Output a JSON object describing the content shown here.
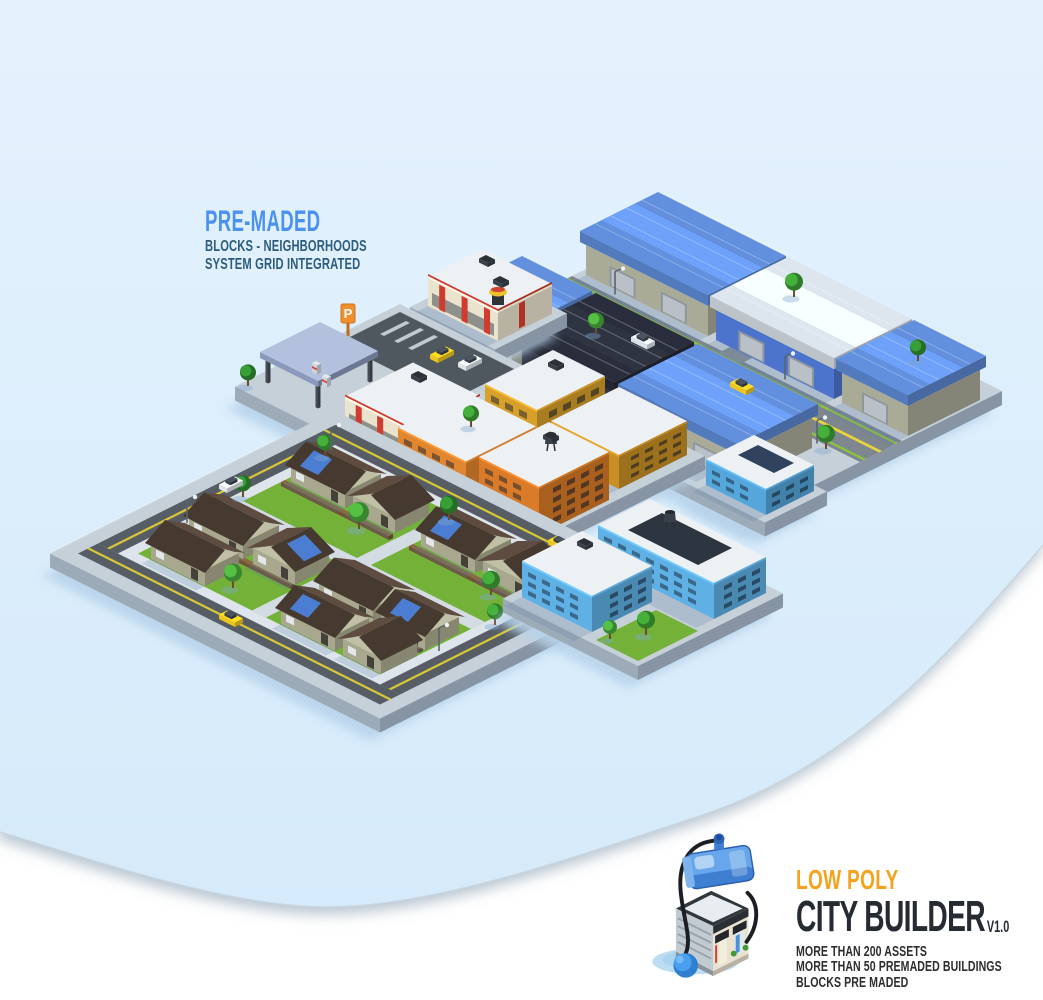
{
  "promo": {
    "headline": "PRE-MADED",
    "sub1": "BLOCKS - NEIGHBORHOODS",
    "sub2": "SYSTEM GRID INTEGRATED",
    "headline_color": "#4a91f0",
    "sub_color": "#2d5c7e"
  },
  "branding": {
    "tagline": "LOW POLY",
    "title": "CITY BUILDER",
    "version": "V1.0",
    "features": [
      "MORE THAN 200 ASSETS",
      "MORE THAN 50 PREMADED BUILDINGS",
      "BLOCKS PRE MADED"
    ],
    "tagline_color": "#f6a21c",
    "title_color": "#262b33",
    "features_color": "#2d2d30",
    "logo_icon": "isometric-shop-with-blue-tank-icon"
  },
  "background": {
    "page_color": "#ffffff",
    "panel_color_top": "#e4f2fd",
    "panel_color_bottom": "#d5eafa",
    "panel_edge_color": "#c6d3de"
  },
  "scene": {
    "anchors": {
      "ind": {
        "x": 672,
        "y": 240
      },
      "rest": {
        "x": 482,
        "y": 285
      },
      "com": {
        "x": 400,
        "y": 318
      },
      "mix": {
        "x": 555,
        "y": 395
      },
      "res": {
        "x": 335,
        "y": 425
      },
      "blu2": {
        "x": 752,
        "y": 468
      },
      "blu": {
        "x": 648,
        "y": 540
      }
    },
    "blocks": {
      "ind": "industrial-district",
      "rest": "restaurant-block",
      "com": "gas-station-block",
      "mix": "apartment-district",
      "res": "residential-suburb",
      "blu2": "corner-store-block",
      "blu": "blue-apartment-block"
    },
    "palette": {
      "platTop": "#c6d0d9",
      "platR": "#8694a3",
      "platL": "#9dabb9",
      "shadow": "rgba(86,124,166,0.22)",
      "asphalt": "#7e868e",
      "asphalt2": "#878f97",
      "edgegreen": "#8fc43e",
      "yellow": "#e8d63c",
      "yellow2": "#d8c636",
      "roadDark": "#565d64",
      "sidewalk": "#dde4ec",
      "path": "#d3dbe3",
      "lawn": "#74b138",
      "lot": "#4f575f",
      "mark": "#c2cad1",
      "panel": "#31425e",
      "court": "#2c3540",
      "whouse": "#a9ab97",
      "wroof": "#6290de"
    },
    "items": [
      {
        "t": "platform",
        "b": "ind",
        "u0": 0,
        "v0": 0,
        "u1": 330,
        "v1": 250,
        "h": 14
      },
      {
        "t": "strip",
        "b": "ind",
        "u0": 0,
        "v0": 100,
        "u1": 330,
        "v1": 142,
        "c": "asphalt"
      },
      {
        "t": "strip",
        "b": "ind",
        "u0": 150,
        "v0": 0,
        "u1": 172,
        "v1": 250,
        "c": "asphalt2"
      },
      {
        "t": "strip",
        "b": "ind",
        "u0": 0,
        "v0": 104,
        "u1": 330,
        "v1": 106.5,
        "c": "edgegreen"
      },
      {
        "t": "strip",
        "b": "ind",
        "u0": 0,
        "v0": 136,
        "u1": 330,
        "v1": 138.5,
        "c": "edgegreen"
      },
      {
        "t": "strip",
        "b": "ind",
        "u0": 0,
        "v0": 120,
        "u1": 330,
        "v1": 123,
        "c": "yellow"
      },
      {
        "t": "wh",
        "b": "ind",
        "u0": 6,
        "v0": 20,
        "u1": 128,
        "v1": 92
      },
      {
        "t": "wh",
        "b": "ind",
        "u0": 136,
        "v0": 20,
        "u1": 254,
        "v1": 92,
        "wc": "#4d74cc",
        "rc": "#dde6ee"
      },
      {
        "t": "wh",
        "b": "ind",
        "u0": 262,
        "v0": 20,
        "u1": 328,
        "v1": 92
      },
      {
        "t": "wh",
        "b": "ind",
        "u0": 2,
        "v0": 152,
        "u1": 66,
        "v1": 226
      },
      {
        "t": "wh",
        "b": "ind",
        "u0": 76,
        "v0": 152,
        "u1": 168,
        "v1": 226,
        "wc": "#323748",
        "rc": "#2a2e3c",
        "trim": "#c23a2e"
      },
      {
        "t": "wh",
        "b": "ind",
        "u0": 178,
        "v0": 152,
        "u1": 292,
        "v1": 226
      },
      {
        "t": "tree",
        "b": "ind",
        "u": 132,
        "v": 10,
        "s": 9
      },
      {
        "t": "tree",
        "b": "ind",
        "u": 258,
        "v": 12,
        "s": 8,
        "c": "#2f8a2e"
      },
      {
        "t": "tree",
        "b": "ind",
        "u": 300,
        "v": 146,
        "s": 9
      },
      {
        "t": "tree",
        "b": "ind",
        "u": 70,
        "v": 146,
        "s": 8,
        "c": "#49a83c"
      },
      {
        "t": "light",
        "b": "ind",
        "u": 40,
        "v": 97
      },
      {
        "t": "light",
        "b": "ind",
        "u": 210,
        "v": 97
      },
      {
        "t": "light",
        "b": "ind",
        "u": 290,
        "v": 145
      },
      {
        "t": "car",
        "b": "ind",
        "u": 190,
        "v": 124,
        "dir": "u",
        "c": "#ecc51f"
      },
      {
        "t": "car",
        "b": "ind",
        "u": 95,
        "v": 128,
        "dir": "u",
        "c": "#dde3e8"
      },
      {
        "t": "platform",
        "b": "rest",
        "u0": 0,
        "v0": 0,
        "u1": 85,
        "v1": 72,
        "h": 14
      },
      {
        "t": "bld",
        "b": "rest",
        "u0": 8,
        "v0": 8,
        "u1": 78,
        "v1": 62,
        "h": 30,
        "c": "#eae4cf",
        "stripes": 1
      },
      {
        "t": "ac",
        "b": "rest",
        "u": 20,
        "v": 16,
        "z": 44
      },
      {
        "t": "ac",
        "b": "rest",
        "u": 48,
        "v": 30,
        "z": 44
      },
      {
        "t": "hotdog",
        "b": "rest",
        "u": 72,
        "v": 56,
        "z": 44
      },
      {
        "t": "platform",
        "b": "com",
        "u0": 0,
        "v0": 0,
        "u1": 165,
        "v1": 165,
        "h": 14
      },
      {
        "t": "strip",
        "b": "com",
        "u0": 8,
        "v0": 8,
        "u1": 122,
        "v1": 70,
        "c": "lot"
      },
      {
        "t": "strip",
        "b": "com",
        "u0": 20,
        "v0": 14,
        "u1": 24,
        "v1": 40,
        "c": "mark"
      },
      {
        "t": "strip",
        "b": "com",
        "u0": 34,
        "v0": 14,
        "u1": 38,
        "v1": 40,
        "c": "mark"
      },
      {
        "t": "strip",
        "b": "com",
        "u0": 48,
        "v0": 14,
        "u1": 52,
        "v1": 40,
        "c": "mark"
      },
      {
        "t": "sign",
        "b": "com",
        "u": 12,
        "v": 64,
        "label": "P"
      },
      {
        "t": "car",
        "b": "com",
        "u": 70,
        "v": 24,
        "dir": "v",
        "c": "#ecc51f"
      },
      {
        "t": "car",
        "b": "com",
        "u": 92,
        "v": 18,
        "dir": "v",
        "c": "#dfe5ea"
      },
      {
        "t": "canopy",
        "b": "com",
        "u0": 8,
        "v0": 88,
        "u1": 66,
        "v1": 148
      },
      {
        "t": "pump",
        "b": "com",
        "u": 24,
        "v": 108
      },
      {
        "t": "pump",
        "b": "com",
        "u": 42,
        "v": 116
      },
      {
        "t": "bld",
        "b": "com",
        "u0": 95,
        "v0": 82,
        "u1": 162,
        "v1": 150,
        "h": 30,
        "c": "#eae4cf",
        "stripes": 1
      },
      {
        "t": "ac",
        "b": "com",
        "u": 110,
        "v": 92,
        "z": 44
      },
      {
        "t": "tree",
        "b": "com",
        "u": 150,
        "v": 8,
        "s": 9
      },
      {
        "t": "tree",
        "b": "com",
        "u": 6,
        "v": 158,
        "s": 8,
        "c": "#2f8a2e"
      },
      {
        "t": "platform",
        "b": "mix",
        "u0": 0,
        "v0": 0,
        "u1": 150,
        "v1": 350,
        "h": 14
      },
      {
        "t": "bld",
        "b": "mix",
        "u0": 10,
        "v0": 12,
        "u1": 62,
        "v1": 80,
        "h": 42,
        "c": "#d7a02b",
        "f": 3
      },
      {
        "t": "bld",
        "b": "mix",
        "u0": 72,
        "v0": 8,
        "u1": 140,
        "v1": 76,
        "h": 34,
        "c": "#c98f25",
        "f": 3
      },
      {
        "t": "ac",
        "b": "mix",
        "u": 24,
        "v": 24,
        "z": 56
      },
      {
        "t": "bld",
        "b": "mix",
        "u0": 8,
        "v0": 95,
        "u1": 76,
        "v1": 165,
        "h": 40,
        "c": "#e0862e",
        "f": 3
      },
      {
        "t": "bld",
        "b": "mix",
        "u0": 86,
        "v0": 92,
        "u1": 146,
        "v1": 162,
        "h": 48,
        "c": "#d97b28",
        "f": 4
      },
      {
        "t": "tower",
        "b": "mix",
        "u": 116,
        "v": 120,
        "z": 62
      },
      {
        "t": "ac",
        "b": "mix",
        "u": 100,
        "v": 105,
        "z": 62
      },
      {
        "t": "bld",
        "b": "mix",
        "u0": 14,
        "v0": 182,
        "u1": 80,
        "v1": 252,
        "h": 38,
        "c": "#e0862e",
        "f": 3
      },
      {
        "t": "bld",
        "b": "mix",
        "u0": 92,
        "v0": 180,
        "u1": 148,
        "v1": 250,
        "h": 34,
        "c": "#58aadc",
        "f": 3
      },
      {
        "t": "bld",
        "b": "mix",
        "u0": 8,
        "v0": 268,
        "u1": 68,
        "v1": 338,
        "h": 42,
        "c": "#4f9fd4",
        "f": 3
      },
      {
        "t": "bld",
        "b": "mix",
        "u0": 80,
        "v0": 270,
        "u1": 142,
        "v1": 340,
        "h": 32,
        "c": "#6cb6e6",
        "f": 2
      },
      {
        "t": "ac",
        "b": "mix",
        "u": 20,
        "v": 280,
        "z": 56
      },
      {
        "t": "tree",
        "b": "mix",
        "u": 4,
        "v": 88,
        "s": 8
      },
      {
        "t": "tree",
        "b": "mix",
        "u": 144,
        "v": 170,
        "s": 8,
        "c": "#49a83c"
      },
      {
        "t": "tree",
        "b": "mix",
        "u": 74,
        "v": 262,
        "s": 8,
        "c": "#2f8a2e"
      },
      {
        "t": "platform",
        "b": "res",
        "u0": 0,
        "v0": 0,
        "u1": 330,
        "v1": 285,
        "h": 14
      },
      {
        "t": "strip",
        "b": "res",
        "u0": 14,
        "v0": 14,
        "u1": 316,
        "v1": 34,
        "c": "roadDark"
      },
      {
        "t": "strip",
        "b": "res",
        "u0": 14,
        "v0": 251,
        "u1": 316,
        "v1": 271,
        "c": "roadDark"
      },
      {
        "t": "strip",
        "b": "res",
        "u0": 14,
        "v0": 34,
        "u1": 34,
        "v1": 251,
        "c": "roadDark"
      },
      {
        "t": "strip",
        "b": "res",
        "u0": 296,
        "v0": 34,
        "u1": 316,
        "v1": 251,
        "c": "roadDark"
      },
      {
        "t": "strip",
        "b": "res",
        "u0": 14,
        "v0": 23,
        "u1": 316,
        "v1": 25.5,
        "c": "yellow2"
      },
      {
        "t": "strip",
        "b": "res",
        "u0": 14,
        "v0": 259.5,
        "u1": 316,
        "v1": 262,
        "c": "yellow2"
      },
      {
        "t": "strip",
        "b": "res",
        "u0": 23,
        "v0": 34,
        "u1": 25.5,
        "v1": 251,
        "c": "yellow2"
      },
      {
        "t": "strip",
        "b": "res",
        "u0": 304.5,
        "v0": 34,
        "u1": 307,
        "v1": 251,
        "c": "yellow2"
      },
      {
        "t": "strip",
        "b": "res",
        "u0": 34,
        "v0": 34,
        "u1": 296,
        "v1": 251,
        "c": "sidewalk"
      },
      {
        "t": "strip",
        "b": "res",
        "u0": 44,
        "v0": 44,
        "u1": 286,
        "v1": 241,
        "c": "lawn"
      },
      {
        "t": "strip",
        "b": "res",
        "u0": 44,
        "v0": 136,
        "u1": 286,
        "v1": 150,
        "c": "path"
      },
      {
        "t": "strip",
        "b": "res",
        "u0": 158,
        "v0": 44,
        "u1": 172,
        "v1": 241,
        "c": "path"
      },
      {
        "t": "fence",
        "b": "res",
        "u0": 48,
        "v0": 98,
        "u1": 156,
        "v1": 102
      },
      {
        "t": "fence",
        "b": "res",
        "u0": 176,
        "v0": 98,
        "u1": 284,
        "v1": 102
      },
      {
        "t": "fence",
        "b": "res",
        "u0": 48,
        "v0": 196,
        "u1": 156,
        "v1": 200
      },
      {
        "t": "fence",
        "b": "res",
        "u0": 176,
        "v0": 196,
        "u1": 284,
        "v1": 200
      },
      {
        "t": "house",
        "b": "res",
        "u0": 48,
        "v0": 56,
        "u1": 102,
        "v1": 92,
        "sp": 1
      },
      {
        "t": "house",
        "b": "res",
        "u0": 110,
        "v0": 58,
        "u1": 152,
        "v1": 92,
        "r": "v"
      },
      {
        "t": "house",
        "b": "res",
        "u0": 178,
        "v0": 56,
        "u1": 232,
        "v1": 92,
        "sp": 1
      },
      {
        "t": "house",
        "b": "res",
        "u0": 240,
        "v0": 58,
        "u1": 286,
        "v1": 92,
        "r": "v"
      },
      {
        "t": "house",
        "b": "res",
        "u0": 48,
        "v0": 158,
        "u1": 102,
        "v1": 194
      },
      {
        "t": "house",
        "b": "res",
        "u0": 112,
        "v0": 160,
        "u1": 154,
        "v1": 194,
        "r": "v",
        "sp": 1
      },
      {
        "t": "house",
        "b": "res",
        "u0": 178,
        "v0": 158,
        "u1": 232,
        "v1": 194
      },
      {
        "t": "house",
        "b": "res",
        "u0": 240,
        "v0": 160,
        "u1": 284,
        "v1": 194,
        "sp": 1
      },
      {
        "t": "house",
        "b": "res",
        "u0": 56,
        "v0": 206,
        "u1": 110,
        "v1": 240
      },
      {
        "t": "house",
        "b": "res",
        "u0": 186,
        "v0": 206,
        "u1": 240,
        "v1": 240,
        "sp": 1
      },
      {
        "t": "house",
        "b": "res",
        "u0": 248,
        "v0": 204,
        "u1": 286,
        "v1": 240,
        "r": "v"
      },
      {
        "t": "tree",
        "b": "res",
        "u": 40,
        "v": 50,
        "s": 8
      },
      {
        "t": "tree",
        "b": "res",
        "u": 166,
        "v": 52,
        "s": 9,
        "c": "#2f8a2e"
      },
      {
        "t": "tree",
        "b": "res",
        "u": 292,
        "v": 50,
        "s": 8
      },
      {
        "t": "tree",
        "b": "res",
        "u": 130,
        "v": 106,
        "s": 10,
        "c": "#49a83c"
      },
      {
        "t": "tree",
        "b": "res",
        "u": 262,
        "v": 106,
        "s": 9
      },
      {
        "t": "tree",
        "b": "res",
        "u": 40,
        "v": 132,
        "s": 8,
        "c": "#2f8a2e"
      },
      {
        "t": "tree",
        "b": "res",
        "u": 294,
        "v": 134,
        "s": 8
      },
      {
        "t": "tree",
        "b": "res",
        "u": 126,
        "v": 228,
        "s": 9,
        "c": "#49a83c"
      },
      {
        "t": "car",
        "b": "res",
        "u": 150,
        "v": 258,
        "dir": "u",
        "c": "#ecc51f"
      },
      {
        "t": "car",
        "b": "res",
        "u": 20,
        "v": 120,
        "dir": "v",
        "c": "#dfe5ea"
      },
      {
        "t": "car",
        "b": "res",
        "u": 240,
        "v": 19,
        "dir": "u",
        "c": "#ecc51f"
      },
      {
        "t": "light",
        "b": "res",
        "u": 38,
        "v": 42
      },
      {
        "t": "light",
        "b": "res",
        "u": 38,
        "v": 186
      },
      {
        "t": "light",
        "b": "res",
        "u": 292,
        "v": 44
      },
      {
        "t": "light",
        "b": "res",
        "u": 292,
        "v": 188
      },
      {
        "t": "platform",
        "b": "blu2",
        "u0": 0,
        "v0": 0,
        "u1": 75,
        "v1": 62,
        "h": 14
      },
      {
        "t": "bld",
        "b": "blu2",
        "u0": 8,
        "v0": 6,
        "u1": 68,
        "v1": 54,
        "h": 26,
        "c": "#55a6da",
        "f": 2
      },
      {
        "t": "strip",
        "b": "blu2",
        "u0": 20,
        "v0": 14,
        "u1": 56,
        "v1": 34,
        "z": 40,
        "c": "panel"
      },
      {
        "t": "platform",
        "b": "blu",
        "u0": 0,
        "v0": 0,
        "u1": 135,
        "v1": 145,
        "h": 14
      },
      {
        "t": "bld",
        "b": "blu",
        "u0": 10,
        "v0": 8,
        "u1": 126,
        "v1": 60,
        "h": 36,
        "c": "#5fb0e4",
        "f": 3
      },
      {
        "t": "strip",
        "b": "blu",
        "u0": 30,
        "v0": 16,
        "u1": 100,
        "v1": 50,
        "z": 50,
        "c": "court"
      },
      {
        "t": "tower",
        "b": "blu",
        "u": 50,
        "v": 28,
        "z": 50
      },
      {
        "t": "bld",
        "b": "blu",
        "u0": 8,
        "v0": 74,
        "u1": 78,
        "v1": 134,
        "h": 36,
        "c": "#5fb0e4",
        "f": 3
      },
      {
        "t": "ac",
        "b": "blu",
        "u": 20,
        "v": 84,
        "z": 50
      },
      {
        "t": "strip",
        "b": "blu",
        "u0": 88,
        "v0": 80,
        "u1": 130,
        "v1": 140,
        "c": "lawn"
      },
      {
        "t": "tree",
        "b": "blu",
        "u": 108,
        "v": 110,
        "s": 9
      },
      {
        "t": "tree",
        "b": "blu",
        "u": 94,
        "v": 132,
        "s": 7,
        "c": "#49a83c"
      }
    ]
  }
}
